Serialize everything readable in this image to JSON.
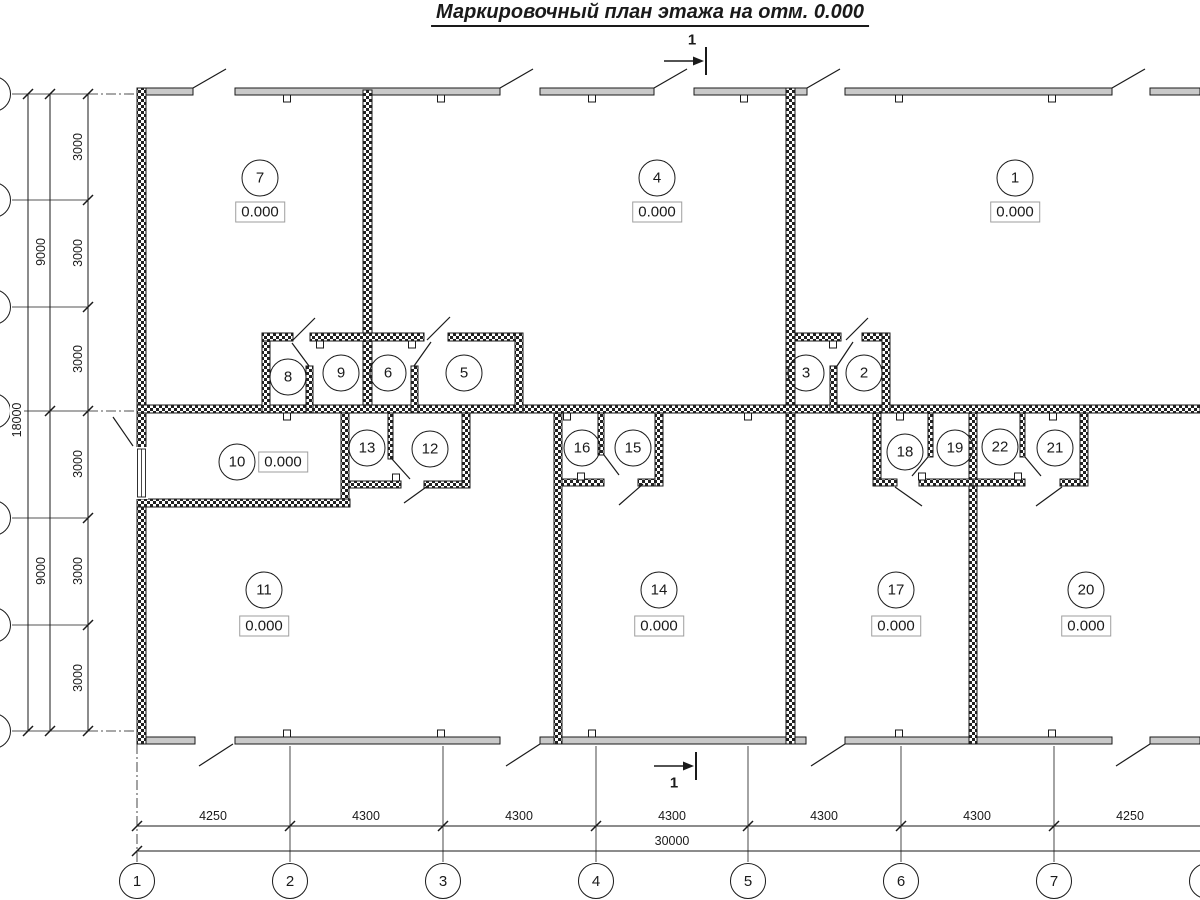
{
  "title": "Маркировочный план этажа на отм. 0.000",
  "palette": {
    "line": "#1a1a1a",
    "facade-fill": "#c9c9c9",
    "elev-border": "#9e9e9e",
    "bg": "#ffffff"
  },
  "rooms": [
    {
      "t": "7",
      "x": 260,
      "y": 178
    },
    {
      "t": "4",
      "x": 657,
      "y": 178
    },
    {
      "t": "1",
      "x": 1015,
      "y": 178
    },
    {
      "t": "8",
      "x": 288,
      "y": 377
    },
    {
      "t": "9",
      "x": 341,
      "y": 373
    },
    {
      "t": "6",
      "x": 388,
      "y": 373
    },
    {
      "t": "5",
      "x": 464,
      "y": 373
    },
    {
      "t": "3",
      "x": 806,
      "y": 373
    },
    {
      "t": "2",
      "x": 864,
      "y": 373
    },
    {
      "t": "10",
      "x": 237,
      "y": 462
    },
    {
      "t": "13",
      "x": 367,
      "y": 448
    },
    {
      "t": "12",
      "x": 430,
      "y": 449
    },
    {
      "t": "16",
      "x": 582,
      "y": 448
    },
    {
      "t": "15",
      "x": 633,
      "y": 448
    },
    {
      "t": "18",
      "x": 905,
      "y": 452
    },
    {
      "t": "19",
      "x": 955,
      "y": 448
    },
    {
      "t": "22",
      "x": 1000,
      "y": 447
    },
    {
      "t": "21",
      "x": 1055,
      "y": 448
    },
    {
      "t": "11",
      "x": 264,
      "y": 590
    },
    {
      "t": "14",
      "x": 659,
      "y": 590
    },
    {
      "t": "17",
      "x": 896,
      "y": 590
    },
    {
      "t": "20",
      "x": 1086,
      "y": 590
    }
  ],
  "elevations": [
    {
      "t": "0.000",
      "x": 260,
      "y": 212
    },
    {
      "t": "0.000",
      "x": 657,
      "y": 212
    },
    {
      "t": "0.000",
      "x": 1015,
      "y": 212
    },
    {
      "t": "0.000",
      "x": 283,
      "y": 462
    },
    {
      "t": "0.000",
      "x": 264,
      "y": 626
    },
    {
      "t": "0.000",
      "x": 659,
      "y": 626
    },
    {
      "t": "0.000",
      "x": 896,
      "y": 626
    },
    {
      "t": "0.000",
      "x": 1086,
      "y": 626
    }
  ],
  "axis_circles": [
    {
      "t": "1",
      "x": 137,
      "y": 881
    },
    {
      "t": "2",
      "x": 290,
      "y": 881
    },
    {
      "t": "3",
      "x": 443,
      "y": 881
    },
    {
      "t": "4",
      "x": 596,
      "y": 881
    },
    {
      "t": "5",
      "x": 748,
      "y": 881
    },
    {
      "t": "6",
      "x": 901,
      "y": 881
    },
    {
      "t": "7",
      "x": 1054,
      "y": 881
    },
    {
      "t": "",
      "x": 1207,
      "y": 881
    },
    {
      "t": "",
      "x": -7,
      "y": 94
    },
    {
      "t": "",
      "x": -7,
      "y": 200
    },
    {
      "t": "",
      "x": -7,
      "y": 307
    },
    {
      "t": "",
      "x": -7,
      "y": 411
    },
    {
      "t": "",
      "x": -7,
      "y": 518
    },
    {
      "t": "",
      "x": -7,
      "y": 625
    },
    {
      "t": "",
      "x": -7,
      "y": 731
    }
  ],
  "dim_labels": [
    {
      "t": "4250",
      "x": 213,
      "y": 816
    },
    {
      "t": "4300",
      "x": 366,
      "y": 816
    },
    {
      "t": "4300",
      "x": 519,
      "y": 816
    },
    {
      "t": "4300",
      "x": 672,
      "y": 816
    },
    {
      "t": "4300",
      "x": 824,
      "y": 816
    },
    {
      "t": "4300",
      "x": 977,
      "y": 816
    },
    {
      "t": "4250",
      "x": 1130,
      "y": 816
    },
    {
      "t": "30000",
      "x": 672,
      "y": 841
    },
    {
      "t": "3000",
      "x": 78,
      "y": 147,
      "rot": 1
    },
    {
      "t": "3000",
      "x": 78,
      "y": 253,
      "rot": 1
    },
    {
      "t": "3000",
      "x": 78,
      "y": 359,
      "rot": 1
    },
    {
      "t": "3000",
      "x": 78,
      "y": 464,
      "rot": 1
    },
    {
      "t": "3000",
      "x": 78,
      "y": 571,
      "rot": 1
    },
    {
      "t": "3000",
      "x": 78,
      "y": 678,
      "rot": 1
    },
    {
      "t": "9000",
      "x": 41,
      "y": 252,
      "rot": 1
    },
    {
      "t": "9000",
      "x": 41,
      "y": 571,
      "rot": 1
    },
    {
      "t": "18000",
      "x": 17,
      "y": 420,
      "rot": 1
    }
  ],
  "section_labels": [
    {
      "t": "1",
      "x": 692,
      "y": 40
    },
    {
      "t": "1",
      "x": 674,
      "y": 783
    }
  ]
}
